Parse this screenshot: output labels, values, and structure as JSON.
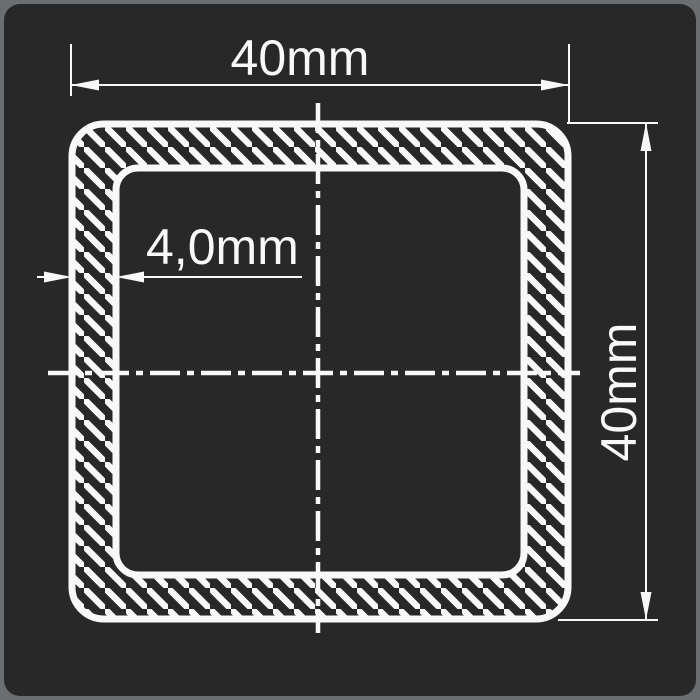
{
  "page": {
    "background_color": "#6b6e70",
    "panel_color": "#282828",
    "line_color": "#f8f8f8"
  },
  "drawing": {
    "kind": "square hollow tube cross-section",
    "labels": {
      "width": "40mm",
      "height": "40mm",
      "wall_thickness": "4,0mm"
    }
  }
}
